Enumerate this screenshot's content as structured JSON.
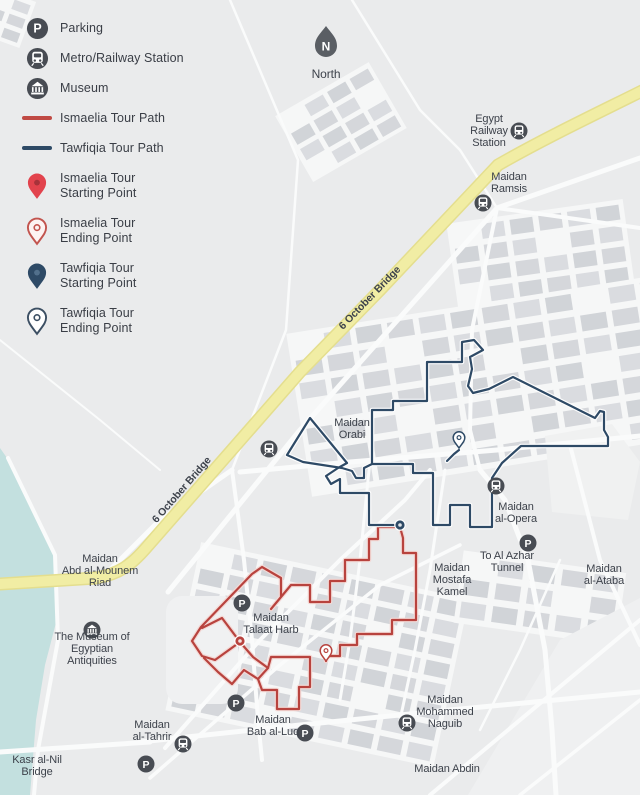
{
  "palette": {
    "background": "#eaebec",
    "blocks": "#d6d8db",
    "streets": "#fafbfb",
    "water": "#c3e0df",
    "bridge_fill": "#f1eda4",
    "bridge_casing": "#e4de8e",
    "icon_dark": "#484c53",
    "label_text": "#3d424b",
    "ismaelia_red": "#b8433e",
    "ismaelia_casing": "#f3d9d6",
    "tawfiqia_navy": "#2e4a66",
    "tawfiqia_casing": "#fdfdfd"
  },
  "legend": {
    "items": [
      {
        "icon": "parking-icon",
        "label": "Parking"
      },
      {
        "icon": "metro-icon",
        "label": "Metro/Railway Station"
      },
      {
        "icon": "museum-icon",
        "label": "Museum"
      },
      {
        "icon": "ismaelia-path-swatch",
        "label": "Ismaelia Tour Path"
      },
      {
        "icon": "tawfiqia-path-swatch",
        "label": "Tawfiqia Tour Path"
      },
      {
        "icon": "ismaelia-start-pin",
        "label": "Ismaelia Tour\nStarting Point"
      },
      {
        "icon": "ismaelia-end-pin",
        "label": "Ismaelia Tour\nEnding Point"
      },
      {
        "icon": "tawfiqia-start-pin",
        "label": "Tawfiqia Tour\nStarting Point"
      },
      {
        "icon": "tawfiqia-end-pin",
        "label": "Tawfiqia Tour\nEnding Point"
      }
    ]
  },
  "map": {
    "north_label": "North",
    "tours": [
      {
        "name": "Ismaelia Tour",
        "id": "ismaelia",
        "color": "#b8433e",
        "casing": "#f3d9d6",
        "strokes": [
          [
            [
              400,
              527
            ],
            [
              378,
              527
            ],
            [
              378,
              539
            ],
            [
              369,
              539
            ],
            [
              369,
              560
            ],
            [
              345,
              560
            ],
            [
              345,
              581
            ],
            [
              330,
              581
            ],
            [
              330,
              602
            ],
            [
              310,
              602
            ],
            [
              310,
              585
            ],
            [
              291,
              585
            ],
            [
              271,
              609
            ],
            [
              281,
              597
            ],
            [
              281,
              578
            ],
            [
              262,
              567
            ],
            [
              252,
              574
            ],
            [
              201,
              627
            ],
            [
              192,
              641
            ],
            [
              202,
              656
            ],
            [
              215,
              660
            ],
            [
              240,
              642
            ],
            [
              222,
              618
            ],
            [
              202,
              628
            ]
          ],
          [
            [
              400,
              527
            ],
            [
              403,
              538
            ],
            [
              403,
              553
            ],
            [
              416,
              553
            ],
            [
              416,
              620
            ],
            [
              392,
              620
            ],
            [
              392,
              634
            ],
            [
              357,
              634
            ],
            [
              357,
              645
            ],
            [
              340,
              645
            ],
            [
              340,
              656
            ],
            [
              326,
              656
            ],
            [
              326,
              661
            ]
          ],
          [
            [
              240,
              642
            ],
            [
              253,
              657
            ],
            [
              268,
              668
            ],
            [
              258,
              679
            ],
            [
              244,
              670
            ],
            [
              232,
              684
            ],
            [
              218,
              672
            ],
            [
              204,
              658
            ]
          ],
          [
            [
              268,
              668
            ],
            [
              271,
              657
            ],
            [
              310,
              657
            ],
            [
              310,
              687
            ],
            [
              299,
              687
            ],
            [
              299,
              709
            ],
            [
              277,
              709
            ],
            [
              277,
              690
            ],
            [
              262,
              690
            ],
            [
              258,
              679
            ]
          ]
        ],
        "start": {
          "x": 240,
          "y": 641
        },
        "end": {
          "x": 326,
          "y": 661
        }
      },
      {
        "name": "Tawfiqia Tour",
        "id": "tawfiqia",
        "color": "#2e4a66",
        "casing": "#fdfdfd",
        "strokes": [
          [
            [
              400,
              525
            ],
            [
              369,
              525
            ],
            [
              369,
              493
            ],
            [
              340,
              493
            ],
            [
              340,
              479
            ],
            [
              331,
              484
            ],
            [
              326,
              476
            ],
            [
              338,
              468
            ],
            [
              347,
              463
            ],
            [
              310,
              418
            ],
            [
              287,
              455
            ],
            [
              303,
              462
            ],
            [
              342,
              468
            ],
            [
              352,
              471
            ],
            [
              356,
              478
            ],
            [
              364,
              478
            ],
            [
              364,
              468
            ],
            [
              372,
              464
            ],
            [
              372,
              410
            ],
            [
              393,
              410
            ],
            [
              393,
              401
            ],
            [
              427,
              401
            ],
            [
              427,
              362
            ],
            [
              462,
              362
            ],
            [
              462,
              342
            ],
            [
              474,
              340
            ],
            [
              483,
              350
            ],
            [
              470,
              357
            ],
            [
              472,
              369
            ],
            [
              468,
              386
            ],
            [
              473,
              393
            ],
            [
              489,
              389
            ],
            [
              513,
              377
            ],
            [
              595,
              418
            ],
            [
              600,
              411
            ],
            [
              604,
              412
            ],
            [
              604,
              430
            ],
            [
              608,
              437
            ],
            [
              608,
              446
            ],
            [
              521,
              446
            ],
            [
              502,
              463
            ],
            [
              492,
              478
            ],
            [
              492,
              527
            ],
            [
              470,
              527
            ],
            [
              470,
              505
            ],
            [
              450,
              505
            ],
            [
              450,
              525
            ],
            [
              433,
              525
            ],
            [
              433,
              473
            ],
            [
              413,
              473
            ],
            [
              413,
              464
            ],
            [
              372,
              464
            ]
          ],
          [
            [
              447,
              461
            ],
            [
              454,
              454
            ],
            [
              459,
              450
            ]
          ]
        ],
        "start": {
          "x": 400,
          "y": 525
        },
        "end": {
          "x": 459,
          "y": 448
        }
      }
    ],
    "markers": [
      {
        "type": "north",
        "x": 326,
        "y": 46
      },
      {
        "type": "metro",
        "x": 519,
        "y": 131
      },
      {
        "type": "metro",
        "x": 483,
        "y": 203
      },
      {
        "type": "metro",
        "x": 269,
        "y": 449
      },
      {
        "type": "metro",
        "x": 496,
        "y": 486
      },
      {
        "type": "metro",
        "x": 407,
        "y": 723
      },
      {
        "type": "metro",
        "x": 183,
        "y": 744
      },
      {
        "type": "parking",
        "x": 528,
        "y": 543
      },
      {
        "type": "parking",
        "x": 242,
        "y": 603
      },
      {
        "type": "parking",
        "x": 236,
        "y": 703
      },
      {
        "type": "parking",
        "x": 305,
        "y": 733
      },
      {
        "type": "parking",
        "x": 146,
        "y": 764
      },
      {
        "type": "museum",
        "x": 92,
        "y": 630
      }
    ],
    "labels": [
      {
        "lines": [
          "North"
        ],
        "x": 326,
        "y": 78,
        "size": 12
      },
      {
        "lines": [
          "Egypt",
          "Railway",
          "Station"
        ],
        "x": 489,
        "y": 122
      },
      {
        "lines": [
          "Maidan",
          "Ramsis"
        ],
        "x": 509,
        "y": 180
      },
      {
        "lines": [
          "6 October Bridge"
        ],
        "x": 372,
        "y": 300,
        "rotate": -46,
        "size": 10.5,
        "bold": true
      },
      {
        "lines": [
          "6 October Bridge"
        ],
        "x": 184,
        "y": 492,
        "rotate": -49,
        "size": 10.5,
        "bold": true
      },
      {
        "lines": [
          "Maidan",
          "Orabi"
        ],
        "x": 352,
        "y": 426
      },
      {
        "lines": [
          "Maidan",
          "al-Opera"
        ],
        "x": 516,
        "y": 510
      },
      {
        "lines": [
          "To Al Azhar",
          "Tunnel"
        ],
        "x": 507,
        "y": 559
      },
      {
        "lines": [
          "Maidan",
          "al-Ataba"
        ],
        "x": 604,
        "y": 572
      },
      {
        "lines": [
          "Maidan",
          "Mostafa",
          "Kamel"
        ],
        "x": 452,
        "y": 571
      },
      {
        "lines": [
          "Maidan",
          "Abd al-Mounem",
          "Riad"
        ],
        "x": 100,
        "y": 562
      },
      {
        "lines": [
          "The Museum of",
          "Egyptian",
          "Antiquities"
        ],
        "x": 92,
        "y": 640
      },
      {
        "lines": [
          "Maidan",
          "Talaat Harb"
        ],
        "x": 271,
        "y": 621
      },
      {
        "lines": [
          "Maidan",
          "al-Tahrir"
        ],
        "x": 152,
        "y": 728
      },
      {
        "lines": [
          "Kasr al-Nil",
          "Bridge"
        ],
        "x": 37,
        "y": 763
      },
      {
        "lines": [
          "Maidan",
          "Bab al-Luq"
        ],
        "x": 273,
        "y": 723
      },
      {
        "lines": [
          "Maidan",
          "Mohammed",
          "Naguib"
        ],
        "x": 445,
        "y": 703
      },
      {
        "lines": [
          "Maidan Abdin"
        ],
        "x": 447,
        "y": 772
      }
    ]
  }
}
